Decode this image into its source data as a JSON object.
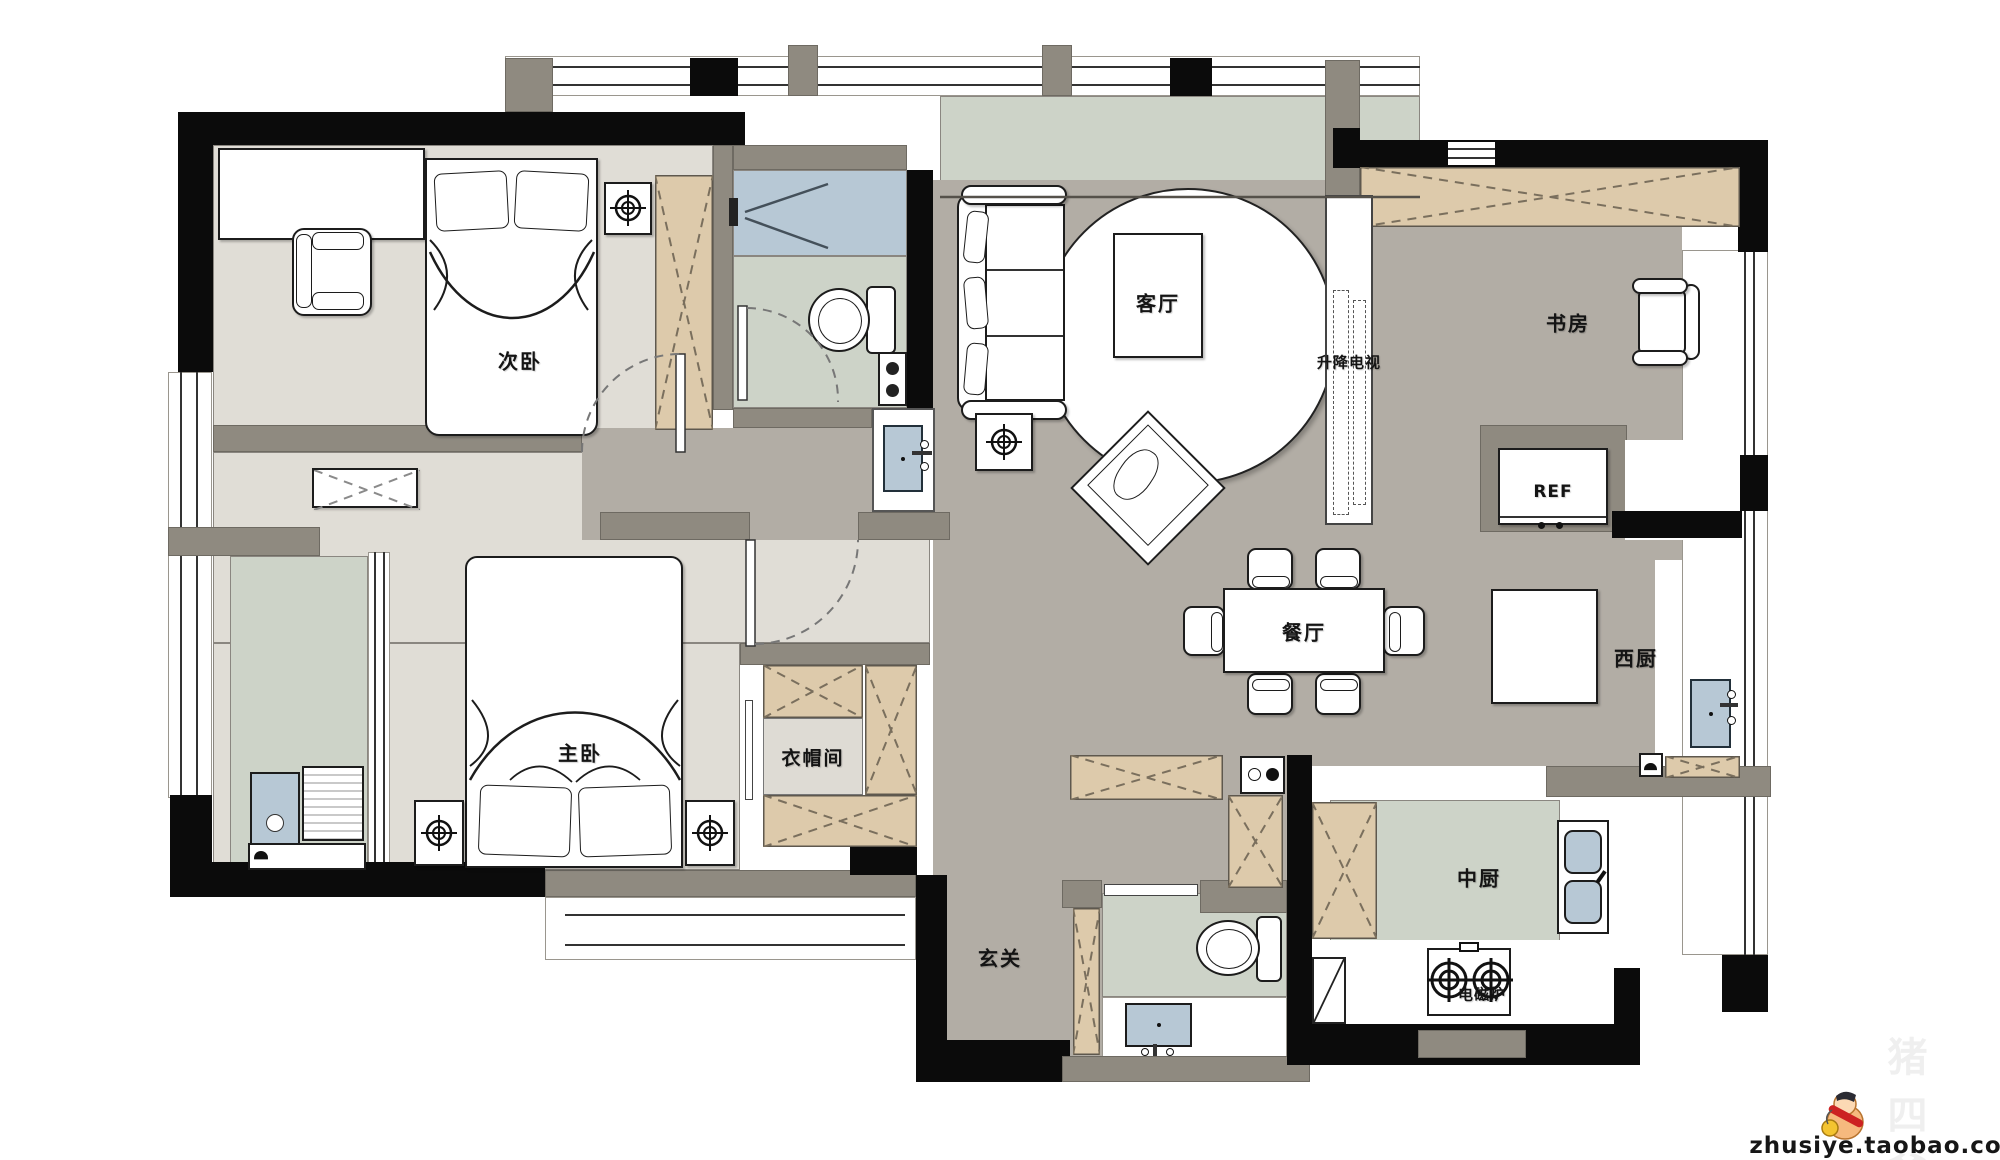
{
  "rooms": {
    "secondary_bedroom": "次卧",
    "master_bedroom": "主卧",
    "living_room": "客厅",
    "dining_room": "餐厅",
    "study": "书房",
    "cloakroom": "衣帽间",
    "foyer": "玄关",
    "west_kitchen": "西厨",
    "chinese_kitchen": "中厨"
  },
  "fixtures": {
    "tv_lift": "升降电视",
    "fridge": "REF",
    "induction_cooker": "电磁炉"
  },
  "watermark": {
    "url_text": "zhusiye.taobao.com",
    "brand_faint": "猪四爷"
  },
  "colors": {
    "floor_public_gray": "#b2ada5",
    "floor_bedroom_light": "#e0ddd6",
    "floor_bath_green": "#cdd3c8",
    "floor_shower_blue": "#b7c8d5",
    "cabinet_tan": "#ddcaab",
    "wall_black": "#0b0b0b",
    "wall_gray": "#8f8a80"
  }
}
